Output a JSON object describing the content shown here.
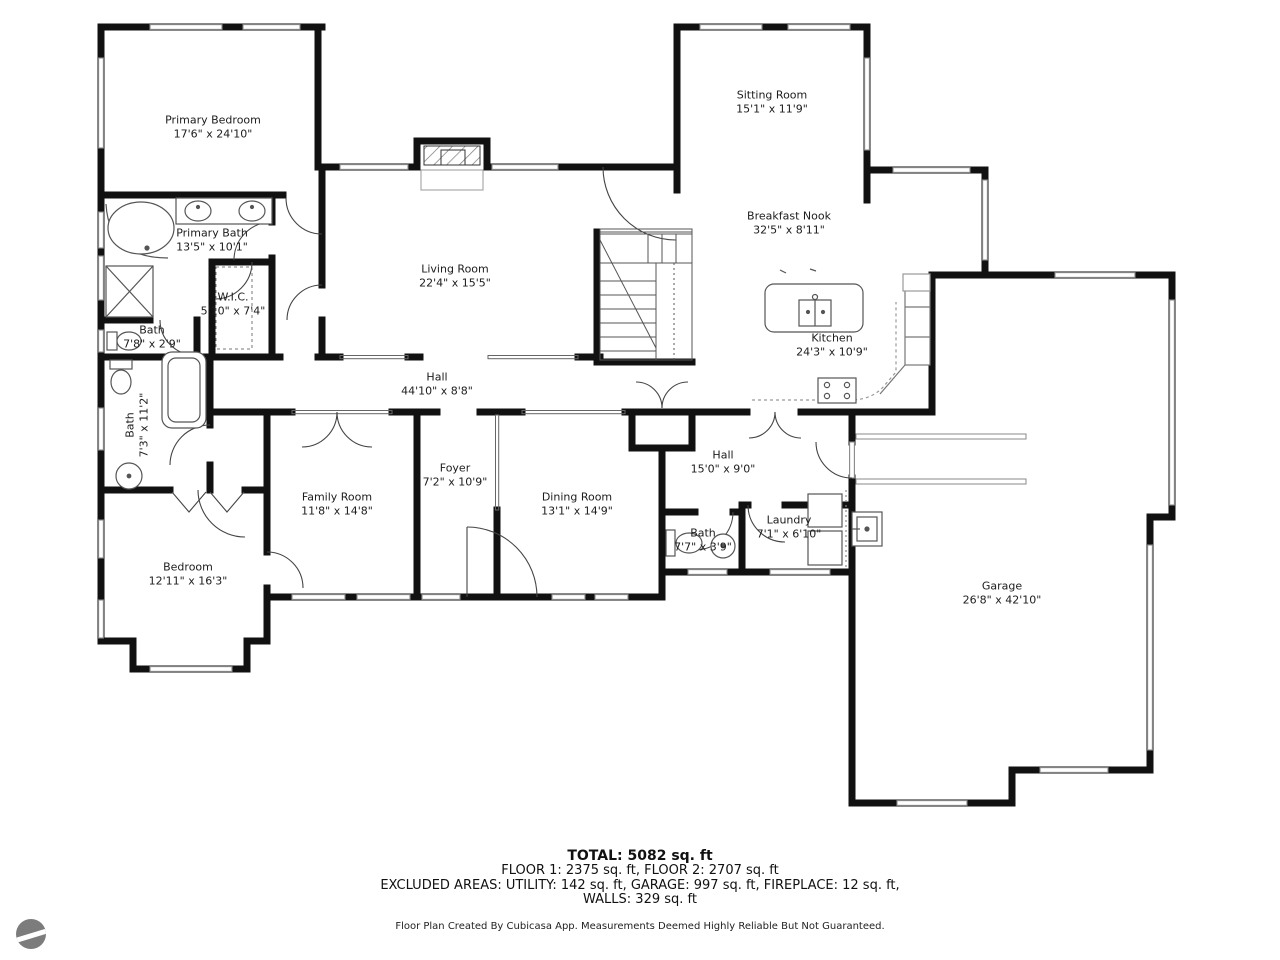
{
  "rooms": [
    {
      "name": "Primary Bedroom",
      "dims": "17'6\" x 24'10\""
    },
    {
      "name": "Sitting Room",
      "dims": "15'1\" x 11'9\""
    },
    {
      "name": "Primary Bath",
      "dims": "13'5\" x 10'1\""
    },
    {
      "name": "W.I.C.",
      "dims": "5'10\" x 7'4\""
    },
    {
      "name": "Bath",
      "dims": "7'8\" x 2'9\""
    },
    {
      "name": "Living Room",
      "dims": "22'4\" x 15'5\""
    },
    {
      "name": "Breakfast Nook",
      "dims": "32'5\" x 8'11\""
    },
    {
      "name": "Kitchen",
      "dims": "24'3\" x 10'9\""
    },
    {
      "name": "Hall",
      "dims": "44'10\" x 8'8\""
    },
    {
      "name": "Bath",
      "dims": "7'3\" x 11'2\""
    },
    {
      "name": "Foyer",
      "dims": "7'2\" x 10'9\""
    },
    {
      "name": "Family Room",
      "dims": "11'8\" x 14'8\""
    },
    {
      "name": "Dining Room",
      "dims": "13'1\" x 14'9\""
    },
    {
      "name": "Hall",
      "dims": "15'0\" x 9'0\""
    },
    {
      "name": "Bath",
      "dims": "7'7\" x 3'9\""
    },
    {
      "name": "Laundry",
      "dims": "7'1\" x 6'10\""
    },
    {
      "name": "Bedroom",
      "dims": "12'11\" x 16'3\""
    },
    {
      "name": "Garage",
      "dims": "26'8\" x 42'10\""
    }
  ],
  "summary": {
    "total": "TOTAL: 5082 sq. ft",
    "floors": "FLOOR 1: 2375 sq. ft, FLOOR 2: 2707 sq. ft",
    "excluded": "EXCLUDED AREAS: UTILITY: 142 sq. ft, GARAGE: 997 sq. ft, FIREPLACE: 12 sq. ft,",
    "walls": "WALLS: 329 sq. ft",
    "disclaimer": "Floor Plan Created By Cubicasa App. Measurements Deemed Highly Reliable But Not Guaranteed."
  },
  "colors": {
    "wall": "#111111",
    "window": "#888888",
    "fixture": "#555555"
  }
}
